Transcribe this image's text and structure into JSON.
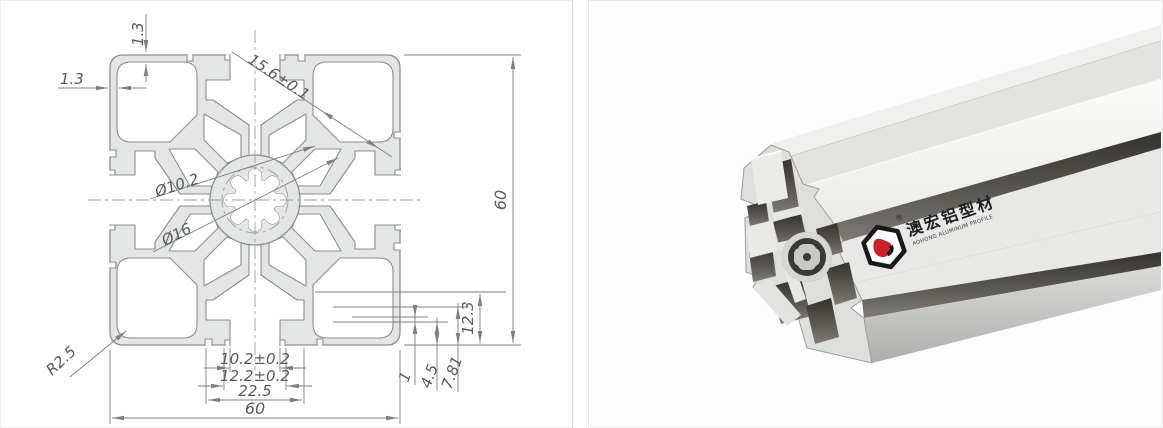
{
  "drawing": {
    "dims": {
      "wall_top": "1.3",
      "wall_left": "1.3",
      "slot_diag": "15.6±0.1",
      "bore_inner": "Ø10.2",
      "bore_outer": "Ø16",
      "height": "60",
      "width": "60",
      "slot_depth": "12.3",
      "screw_depth": "7.81",
      "lip": "4.5",
      "step": "1",
      "slot_opening": "10.2±0.2",
      "slot_outer_opening": "12.2±0.2",
      "cavity_width": "22.5",
      "corner_radius": "R2.5"
    }
  },
  "photo": {
    "brand_cn": "澳宏铝型材",
    "brand_en": "AOHONG ALUMINUM PROFILE",
    "registered_mark": "®"
  },
  "colors": {
    "logo_red": "#c9202a",
    "drawing_fill": "#e4e5e5",
    "drawing_line": "#8a8e92"
  }
}
